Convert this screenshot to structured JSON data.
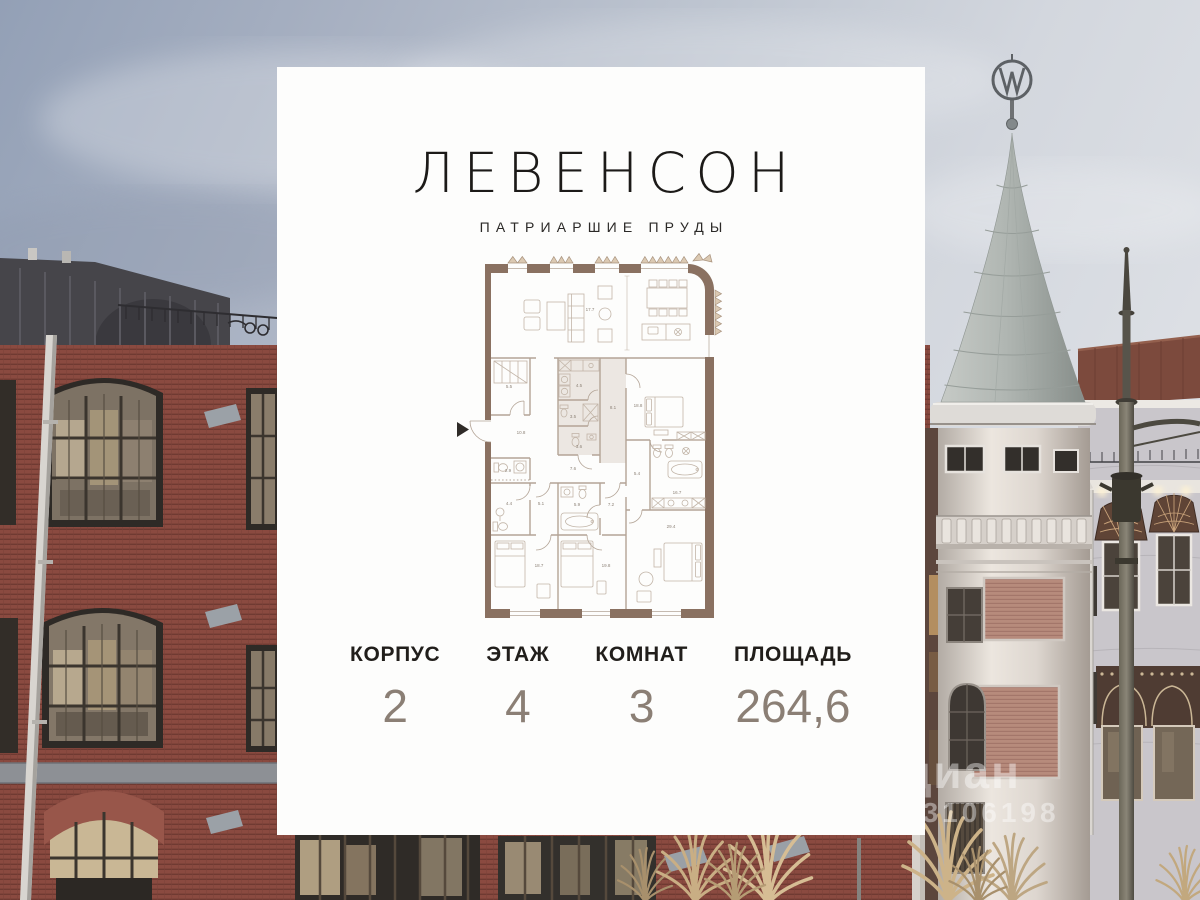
{
  "card": {
    "title": "ЛЕВЕНСОН",
    "subtitle": "ПАТРИАРШИЕ ПРУДЫ",
    "stats": [
      {
        "label": "КОРПУС",
        "value": "2"
      },
      {
        "label": "ЭТАЖ",
        "value": "4"
      },
      {
        "label": "КОМНАТ",
        "value": "3"
      },
      {
        "label": "ПЛОЩАДЬ",
        "value": "264,6"
      }
    ]
  },
  "floorplan": {
    "total_area_m2": "264,6",
    "room_labels": [
      {
        "text": "17.7",
        "x": 150,
        "y": 61
      },
      {
        "text": "5.5",
        "x": 69,
        "y": 138
      },
      {
        "text": "10.8",
        "x": 81,
        "y": 184
      },
      {
        "text": "4.5",
        "x": 139,
        "y": 137
      },
      {
        "text": "3.5",
        "x": 133,
        "y": 168
      },
      {
        "text": "3.6",
        "x": 139,
        "y": 198
      },
      {
        "text": "8.1",
        "x": 173,
        "y": 159
      },
      {
        "text": "18.8",
        "x": 198,
        "y": 157
      },
      {
        "text": "2.9",
        "x": 68,
        "y": 222
      },
      {
        "text": "7.6",
        "x": 133,
        "y": 220
      },
      {
        "text": "5.4",
        "x": 197,
        "y": 225
      },
      {
        "text": "16.7",
        "x": 237,
        "y": 244
      },
      {
        "text": "4.4",
        "x": 69,
        "y": 255
      },
      {
        "text": "5.1",
        "x": 101,
        "y": 255
      },
      {
        "text": "5.9",
        "x": 137,
        "y": 256
      },
      {
        "text": "7.2",
        "x": 171,
        "y": 256
      },
      {
        "text": "29.4",
        "x": 231,
        "y": 278
      },
      {
        "text": "18.7",
        "x": 99,
        "y": 317
      },
      {
        "text": "19.8",
        "x": 166,
        "y": 317
      }
    ]
  },
  "watermark": {
    "brand": "циан",
    "id": "53106198"
  },
  "colors": {
    "plan_wall": "#8a7161",
    "plan_line": "#b3a496",
    "plan_fill": "#ece7e2",
    "plan_label": "#8e8378",
    "stat_value": "#8b7f75",
    "card_bg": "#fdfdfc",
    "brick": "#8a4a40",
    "turret_roof": "#b3b8b4"
  }
}
